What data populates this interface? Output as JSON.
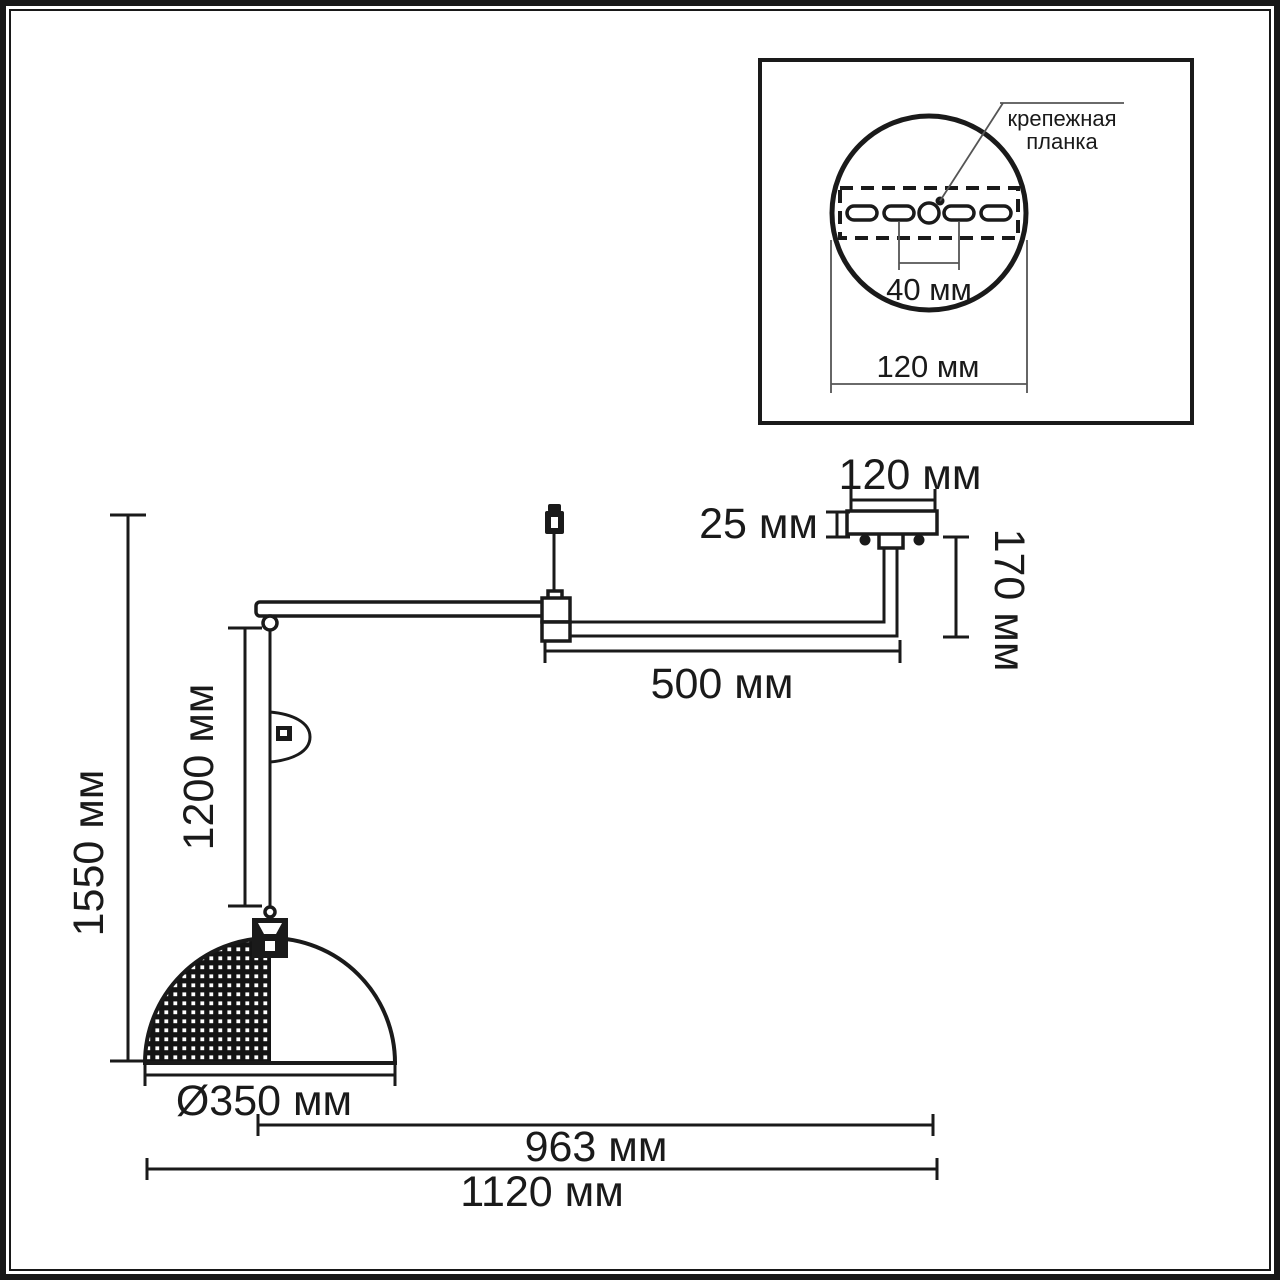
{
  "colors": {
    "ink": "#1a1a1a",
    "leader": "#555555",
    "background": "#ffffff"
  },
  "inset": {
    "callout": {
      "line1": "крепежная",
      "line2": "планка"
    },
    "dims": {
      "slot_spacing": "40 мм",
      "plate_width": "120 мм"
    }
  },
  "main": {
    "dims": {
      "canopy_width": "120 мм",
      "canopy_height": "25 мм",
      "stem_height": "170 мм",
      "arm_length": "500 мм",
      "overall_height": "1550 мм",
      "cord_length": "1200 мм",
      "shade_diameter": "Ø350 мм",
      "reach": "963 мм",
      "overall_width": "1120 мм"
    }
  }
}
